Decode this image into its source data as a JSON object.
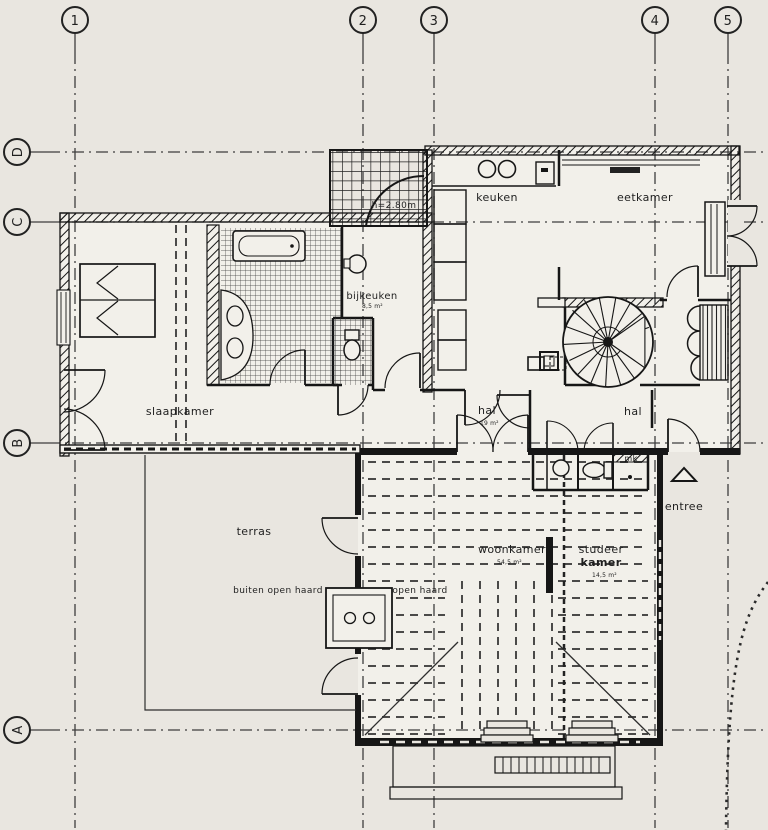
{
  "grid": {
    "columns": [
      "1",
      "2",
      "3",
      "4",
      "5"
    ],
    "rows": [
      "D",
      "C",
      "B",
      "A"
    ]
  },
  "rooms": {
    "keuken": "keuken",
    "eetkamer": "eetkamer",
    "bijkeuken": "bijkeuken",
    "bijkeuken_area": "8,5 m²",
    "slaapkamer": "slaapkamer",
    "hal_west": "hal",
    "hal_west_area": "19 m²",
    "hal_east": "hal",
    "woonkamer": "woonkamer",
    "woonkamer_area": "54,5 m²",
    "studeer_line1": "studeer",
    "studeer_line2": "kamer",
    "studeer_area": "14,5 m²",
    "terras": "terras",
    "entree": "entree"
  },
  "annotations": {
    "height": "h=2.80m",
    "mk": "mk",
    "buiten_open_haard": "buiten open haard",
    "open_haard": "open haard"
  },
  "colors": {
    "paper": "#e9e6e0",
    "room": "#f2f0ea",
    "ink": "#1b1b1b"
  }
}
